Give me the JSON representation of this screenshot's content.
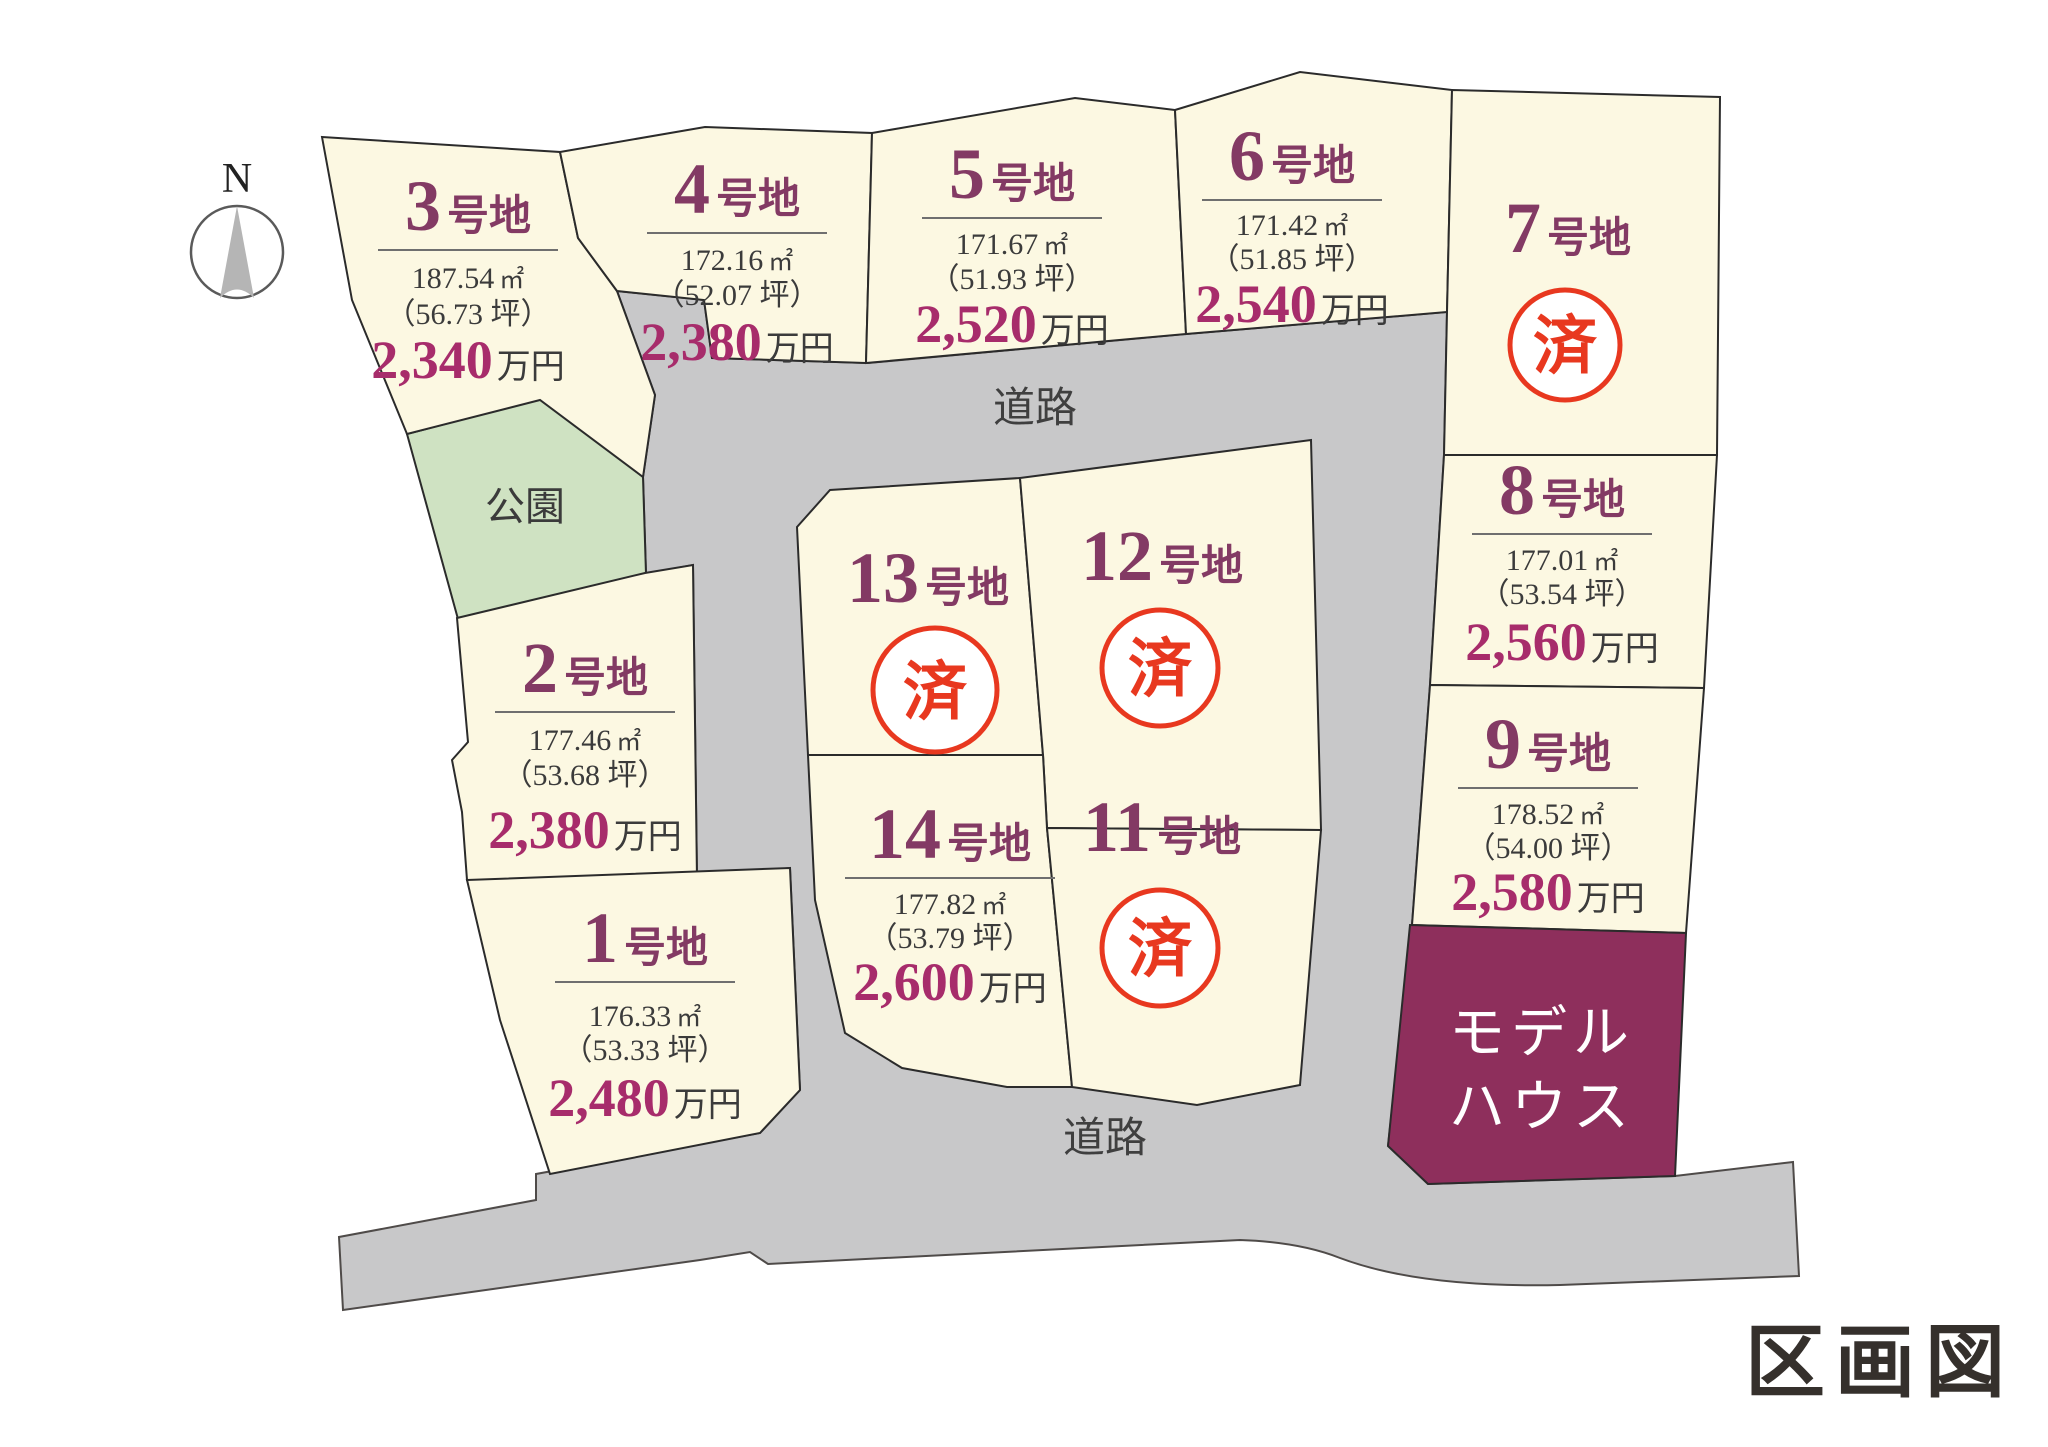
{
  "page_title": "区画図",
  "compass": {
    "north_label": "N"
  },
  "labels": {
    "road": "道路",
    "park": "公園",
    "sold": "済"
  },
  "model_house": {
    "line1": "モデル",
    "line2": "ハウス"
  },
  "colors": {
    "lot_fill": "#fcf8e2",
    "road_fill": "#c8c8c9",
    "park_fill": "#cfe2c2",
    "model_house_fill": "#8e2f5c",
    "lot_number": "#833a64",
    "price": "#a72c6b",
    "sold_red": "#e8381f"
  },
  "lots": [
    {
      "number": "1",
      "suffix": "号地",
      "area": "176.33",
      "area_unit": "㎡",
      "tsubo": "（53.33 坪）",
      "price": "2,480",
      "price_unit": "万円",
      "status": "available"
    },
    {
      "number": "2",
      "suffix": "号地",
      "area": "177.46",
      "area_unit": "㎡",
      "tsubo": "（53.68 坪）",
      "price": "2,380",
      "price_unit": "万円",
      "status": "available"
    },
    {
      "number": "3",
      "suffix": "号地",
      "area": "187.54",
      "area_unit": "㎡",
      "tsubo": "（56.73 坪）",
      "price": "2,340",
      "price_unit": "万円",
      "status": "available"
    },
    {
      "number": "4",
      "suffix": "号地",
      "area": "172.16",
      "area_unit": "㎡",
      "tsubo": "（52.07 坪）",
      "price": "2,380",
      "price_unit": "万円",
      "status": "available"
    },
    {
      "number": "5",
      "suffix": "号地",
      "area": "171.67",
      "area_unit": "㎡",
      "tsubo": "（51.93 坪）",
      "price": "2,520",
      "price_unit": "万円",
      "status": "available"
    },
    {
      "number": "6",
      "suffix": "号地",
      "area": "171.42",
      "area_unit": "㎡",
      "tsubo": "（51.85 坪）",
      "price": "2,540",
      "price_unit": "万円",
      "status": "available"
    },
    {
      "number": "7",
      "suffix": "号地",
      "status": "sold"
    },
    {
      "number": "8",
      "suffix": "号地",
      "area": "177.01",
      "area_unit": "㎡",
      "tsubo": "（53.54 坪）",
      "price": "2,560",
      "price_unit": "万円",
      "status": "available"
    },
    {
      "number": "9",
      "suffix": "号地",
      "area": "178.52",
      "area_unit": "㎡",
      "tsubo": "（54.00 坪）",
      "price": "2,580",
      "price_unit": "万円",
      "status": "available"
    },
    {
      "number": "11",
      "suffix": "号地",
      "status": "sold"
    },
    {
      "number": "12",
      "suffix": "号地",
      "status": "sold"
    },
    {
      "number": "13",
      "suffix": "号地",
      "status": "sold"
    },
    {
      "number": "14",
      "suffix": "号地",
      "area": "177.82",
      "area_unit": "㎡",
      "tsubo": "（53.79 坪）",
      "price": "2,600",
      "price_unit": "万円",
      "status": "available"
    }
  ]
}
